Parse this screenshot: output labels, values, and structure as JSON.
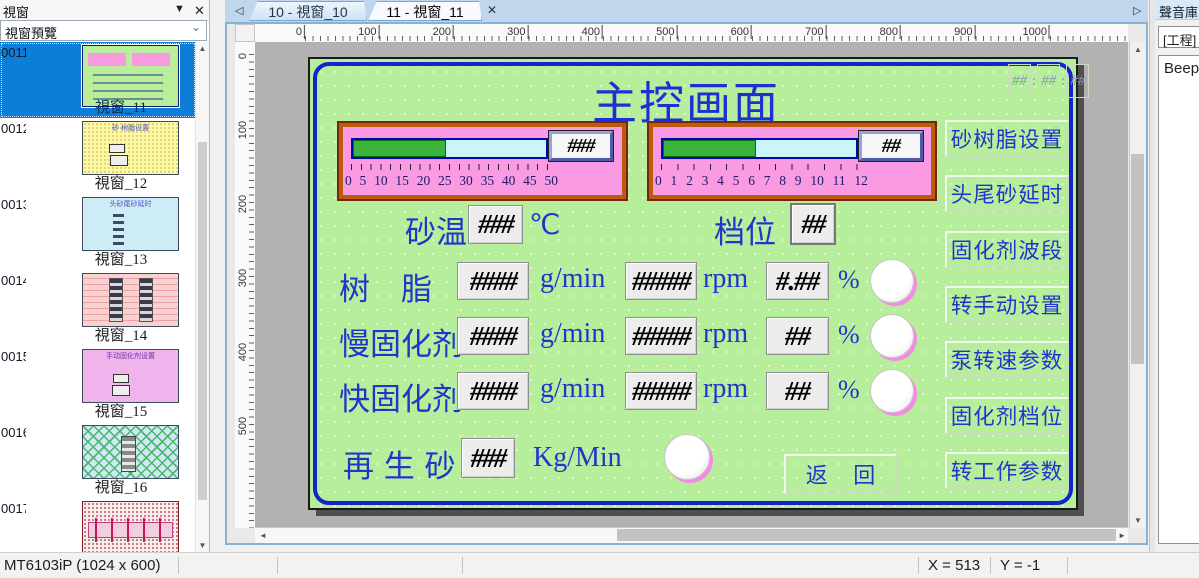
{
  "sidebar": {
    "title": "視窗",
    "preview_label": "視窗預覽",
    "windows": [
      {
        "number": "0011",
        "name": "視窗_11",
        "variant": "main",
        "selected": true,
        "thumb_title": ""
      },
      {
        "number": "0012",
        "name": "視窗_12",
        "variant": "yellow",
        "selected": false,
        "thumb_title": "砂·树脂设置"
      },
      {
        "number": "0013",
        "name": "視窗_13",
        "variant": "cyan",
        "selected": false,
        "thumb_title": "头砂尾砂延时"
      },
      {
        "number": "0014",
        "name": "視窗_14",
        "variant": "brick",
        "selected": false,
        "thumb_title": ""
      },
      {
        "number": "0015",
        "name": "視窗_15",
        "variant": "violet",
        "selected": false,
        "thumb_title": "手动固化剂设置"
      },
      {
        "number": "0016",
        "name": "視窗_16",
        "variant": "hatch",
        "selected": false,
        "thumb_title": ""
      },
      {
        "number": "0017",
        "name": "視窗_17",
        "variant": "reddots",
        "selected": false,
        "thumb_title": ""
      }
    ]
  },
  "tabs": [
    {
      "label": "10 - 視窗_10",
      "active": false
    },
    {
      "label": "11 - 視窗_11",
      "active": true
    }
  ],
  "ruler": {
    "h_labels": [
      "0",
      "100",
      "200",
      "300",
      "400",
      "500",
      "600",
      "700",
      "800",
      "900",
      "1000"
    ],
    "v_labels": [
      "0",
      "100",
      "200",
      "300",
      "400",
      "500"
    ]
  },
  "screen": {
    "title": "主控画面",
    "clock": {
      "h": "##",
      "m": "##",
      "s": "##",
      "separator": ":"
    },
    "gauges": [
      {
        "value": "###",
        "fill_pct": 48,
        "scale": [
          "0",
          "5",
          "10",
          "15",
          "20",
          "25",
          "30",
          "35",
          "40",
          "45",
          "50"
        ]
      },
      {
        "value": "##",
        "fill_pct": 48,
        "scale": [
          "0",
          "1",
          "2",
          "3",
          "4",
          "5",
          "6",
          "7",
          "8",
          "9",
          "10",
          "11",
          "12"
        ]
      }
    ],
    "sand_temp": {
      "label": "砂温",
      "value": "###",
      "unit": "℃"
    },
    "gear": {
      "label": "档位",
      "value": "##"
    },
    "rows": [
      {
        "label": "树　脂",
        "v1": "####",
        "u1": "g/min",
        "v2": "#####",
        "u2": "rpm",
        "v3": "#.##",
        "u3": "%"
      },
      {
        "label": "慢固化剂",
        "v1": "####",
        "u1": "g/min",
        "v2": "#####",
        "u2": "rpm",
        "v3": "##",
        "u3": "%"
      },
      {
        "label": "快固化剂",
        "v1": "####",
        "u1": "g/min",
        "v2": "#####",
        "u2": "rpm",
        "v3": "##",
        "u3": "%"
      }
    ],
    "sand_row": {
      "label": "再 生 砂",
      "value": "###",
      "unit": "Kg/Min"
    },
    "back_button": "返 回",
    "menu_buttons": [
      "砂树脂设置",
      "头尾砂延时",
      "固化剂波段",
      "转手动设置",
      "泵转速参数",
      "固化剂档位",
      "转工作参数"
    ]
  },
  "right_panel": {
    "title": "聲音庫",
    "combo": "[工程]",
    "list": [
      "Beep"
    ]
  },
  "statusbar": {
    "device": "MT6103iP (1024 x 600)",
    "x": "X = 513",
    "y": "Y = -1"
  },
  "colors": {
    "screen_bg": "#b6ee9b",
    "screen_text_blue": "#2135cc",
    "gauge_panel_pink": "#fa9ae2",
    "gauge_border_orange": "#b95c10",
    "bar_fill_green": "#3cb33c",
    "bar_track_cyan": "#c9f6fb",
    "selection_blue": "#0d7ed8",
    "lamp_ring_pink": "#f48ae4",
    "tabstrip_blue": "#bfd6ec"
  }
}
